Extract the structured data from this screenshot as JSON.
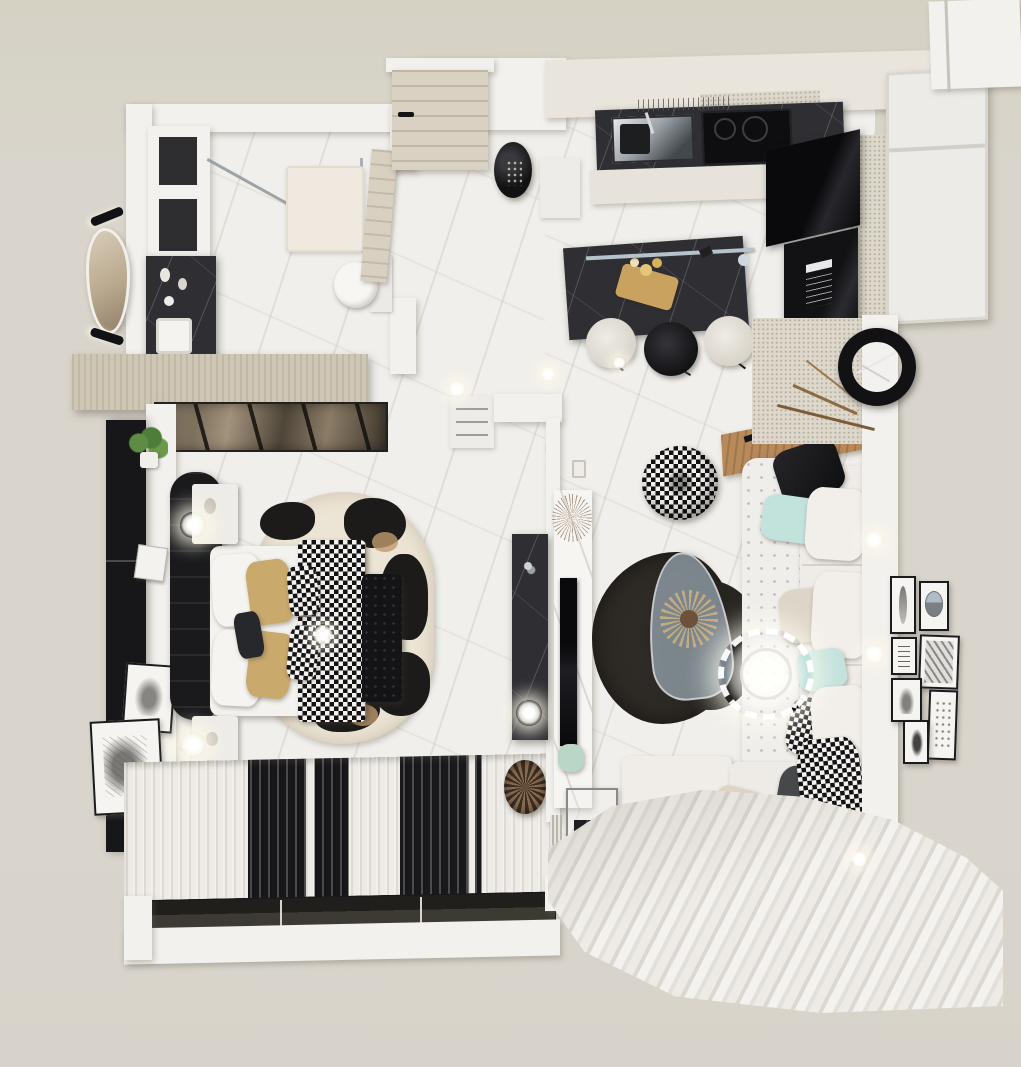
{
  "scene": {
    "title": "Black and White Studio Apartment - Top-Down 3D Render",
    "type": "architectural-visualization",
    "view": "top-down"
  },
  "palette": {
    "background": "#d9d5cc",
    "wall": "#f3f1ed",
    "floor_marble": "#f1efeb",
    "dark_marble": "#2f2e33",
    "wood_light": "#d3cbba",
    "oak_shelf": "#b8895a",
    "black": "#151517",
    "mint_pillow": "#c2e2dc",
    "tan_pillow": "#c9a96c",
    "cowhide_tan": "#c09a6e",
    "curtain_white": "#eeebe6",
    "rug_dark": "#2e2a25",
    "glass_blue": "#9aa4ad",
    "bronze_mirror": "#7d705d"
  },
  "rooms": [
    {
      "name": "Bathroom",
      "furniture": [
        "storage shelves",
        "walk-in shower with glass",
        "toilet",
        "black marble vanity",
        "sink",
        "organic mirror",
        "two wall sconces",
        "wood door"
      ]
    },
    {
      "name": "Entry Hall",
      "furniture": [
        "wood entry door",
        "black decor vase",
        "ceiling spotlights"
      ]
    },
    {
      "name": "Kitchen",
      "furniture": [
        "upper cabinet band",
        "dark marble counter",
        "chrome sink",
        "black cooktop",
        "vent panel",
        "black appliance column with oven",
        "tall white cabinets",
        "dark marble island",
        "linear pendant light",
        "three bar stools"
      ]
    },
    {
      "name": "Bedroom",
      "furniture": [
        "wood wardrobe top",
        "bronze mirrored wardrobe",
        "white drawer unit",
        "black wardrobe panel",
        "hanging plant",
        "two sketch frames",
        "double bed",
        "black wide headboard",
        "two nightstands",
        "two glowing sphere lamps",
        "white and tan pillows",
        "houndstooth throw",
        "jewel brooch decor",
        "cowhide oval rug",
        "black tufted bench",
        "striped blackout curtains",
        "window track",
        "ribbed basket",
        "black marble TV console"
      ]
    },
    {
      "name": "Living Room",
      "furniture": [
        "houndstooth pouf",
        "white tufted chesterfield sofa",
        "chaise module",
        "oak console shelf",
        "scatter pillows",
        "feather ring chandelier",
        "glass teardrop coffee table",
        "pampas centerpiece",
        "organic dark rug",
        "white marble media wall",
        "wall TV",
        "green glass vase",
        "light switch",
        "glass terrarium side table",
        "slatted divider",
        "black ring wall clock",
        "textured accent wall",
        "gallery wall of seven frames",
        "sheer curtain sweep",
        "LED wall glows"
      ]
    }
  ]
}
